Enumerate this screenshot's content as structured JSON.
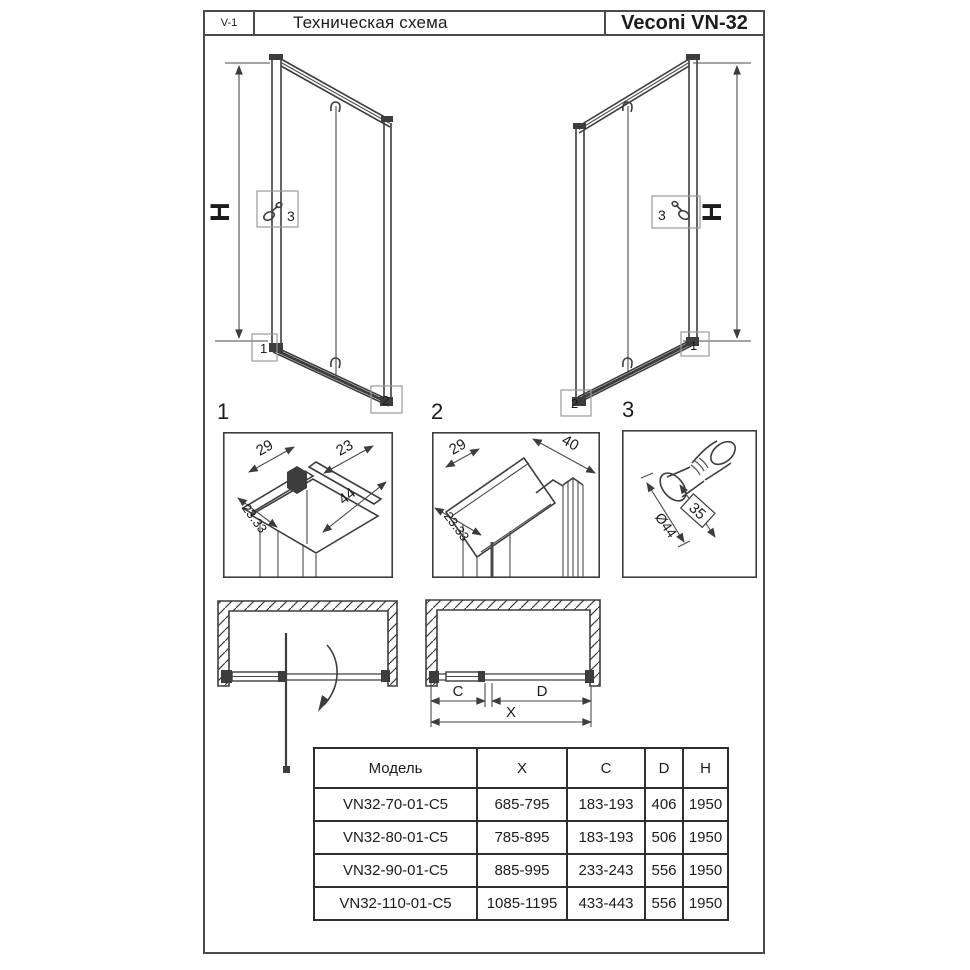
{
  "header": {
    "code": "V-1",
    "title": "Техническая схема",
    "product": "Veconi VN-32"
  },
  "elevation_left": {
    "height_label": "H",
    "callout_knob": "3",
    "callout_bottom_left": "1",
    "callout_bottom_right": "2"
  },
  "elevation_right": {
    "height_label": "H",
    "callout_knob": "3",
    "callout_bottom_left": "2",
    "callout_bottom_right": "1"
  },
  "details": {
    "d1": {
      "label": "1",
      "dim_top_left": "29",
      "dim_top_right": "23",
      "dim_side": "23.33",
      "dim_bottom": "44"
    },
    "d2": {
      "label": "2",
      "dim_top_left": "29",
      "dim_top_right": "40",
      "dim_side": "23.33"
    },
    "d3": {
      "label": "3",
      "dim_length": "35",
      "dim_diameter": "Ø44"
    }
  },
  "plan": {
    "dim_c": "C",
    "dim_d": "D",
    "dim_x": "X"
  },
  "table": {
    "headers": [
      "Модель",
      "X",
      "C",
      "D",
      "H"
    ],
    "rows": [
      [
        "VN32-70-01-C5",
        "685-795",
        "183-193",
        "406",
        "1950"
      ],
      [
        "VN32-80-01-C5",
        "785-895",
        "183-193",
        "506",
        "1950"
      ],
      [
        "VN32-90-01-C5",
        "885-995",
        "233-243",
        "556",
        "1950"
      ],
      [
        "VN32-110-01-C5",
        "1085-1195",
        "433-443",
        "556",
        "1950"
      ]
    ]
  },
  "icons": {
    "knob": "knob-icon",
    "roller_hook": "roller-hook-icon"
  },
  "colors": {
    "line": "#3d3d3d",
    "text": "#1c1c1c",
    "background": "#ffffff"
  }
}
